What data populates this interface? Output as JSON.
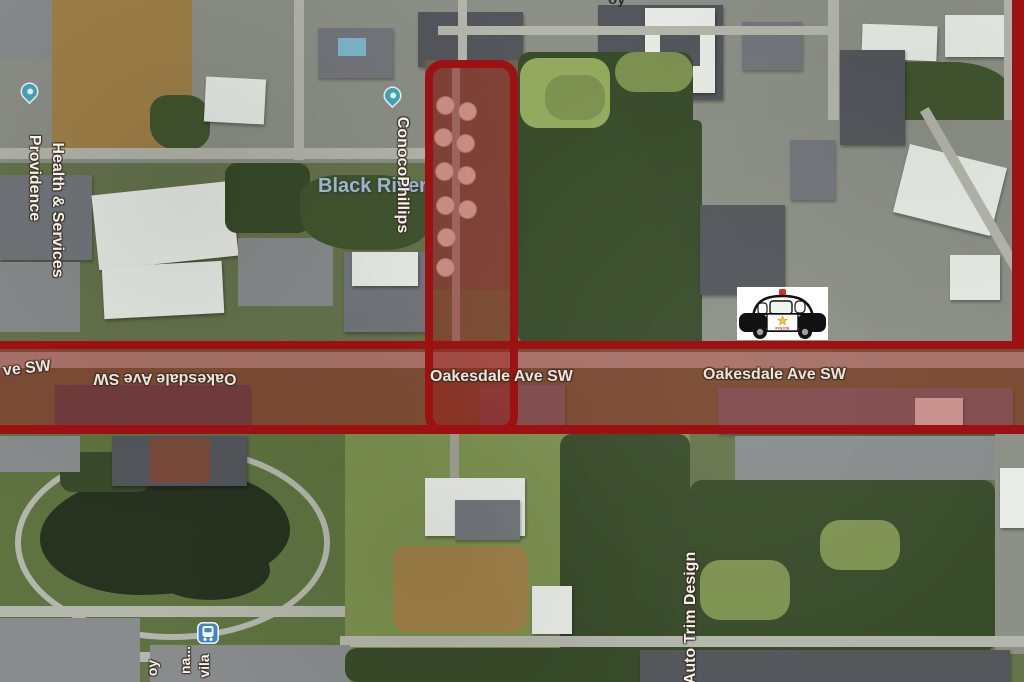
{
  "map": {
    "road_labels": {
      "left_partial": "ve SW",
      "flipped": "Oakesdale Ave SW",
      "center": "Oakesdale Ave SW",
      "right": "Oakesdale Ave SW"
    },
    "places": {
      "providence_line1": "Providence",
      "providence_line2": "Health & Services",
      "black_river": "Black River",
      "conocophillips": "ConocoPhillips",
      "auto_trim": "Auto Trim Design"
    },
    "fragments": {
      "top_edge": "oy",
      "bottom_1": "oy",
      "bottom_2": "na...",
      "bottom_3": "vila"
    },
    "police_car": {
      "door_text": "POLICE"
    },
    "icons": {
      "police_car": "police-car-marker",
      "transit_station": "transit-station-icon",
      "providence_pin": "map-pin",
      "conocophillips_pin": "map-pin"
    },
    "colors": {
      "highlight_border": "#9e1112",
      "highlight_fill": "rgba(155,25,22,0.42)",
      "pin_teal": "#41a0b3",
      "transit_blue": "#3f87c5",
      "water_label": "#9db4c9"
    }
  }
}
